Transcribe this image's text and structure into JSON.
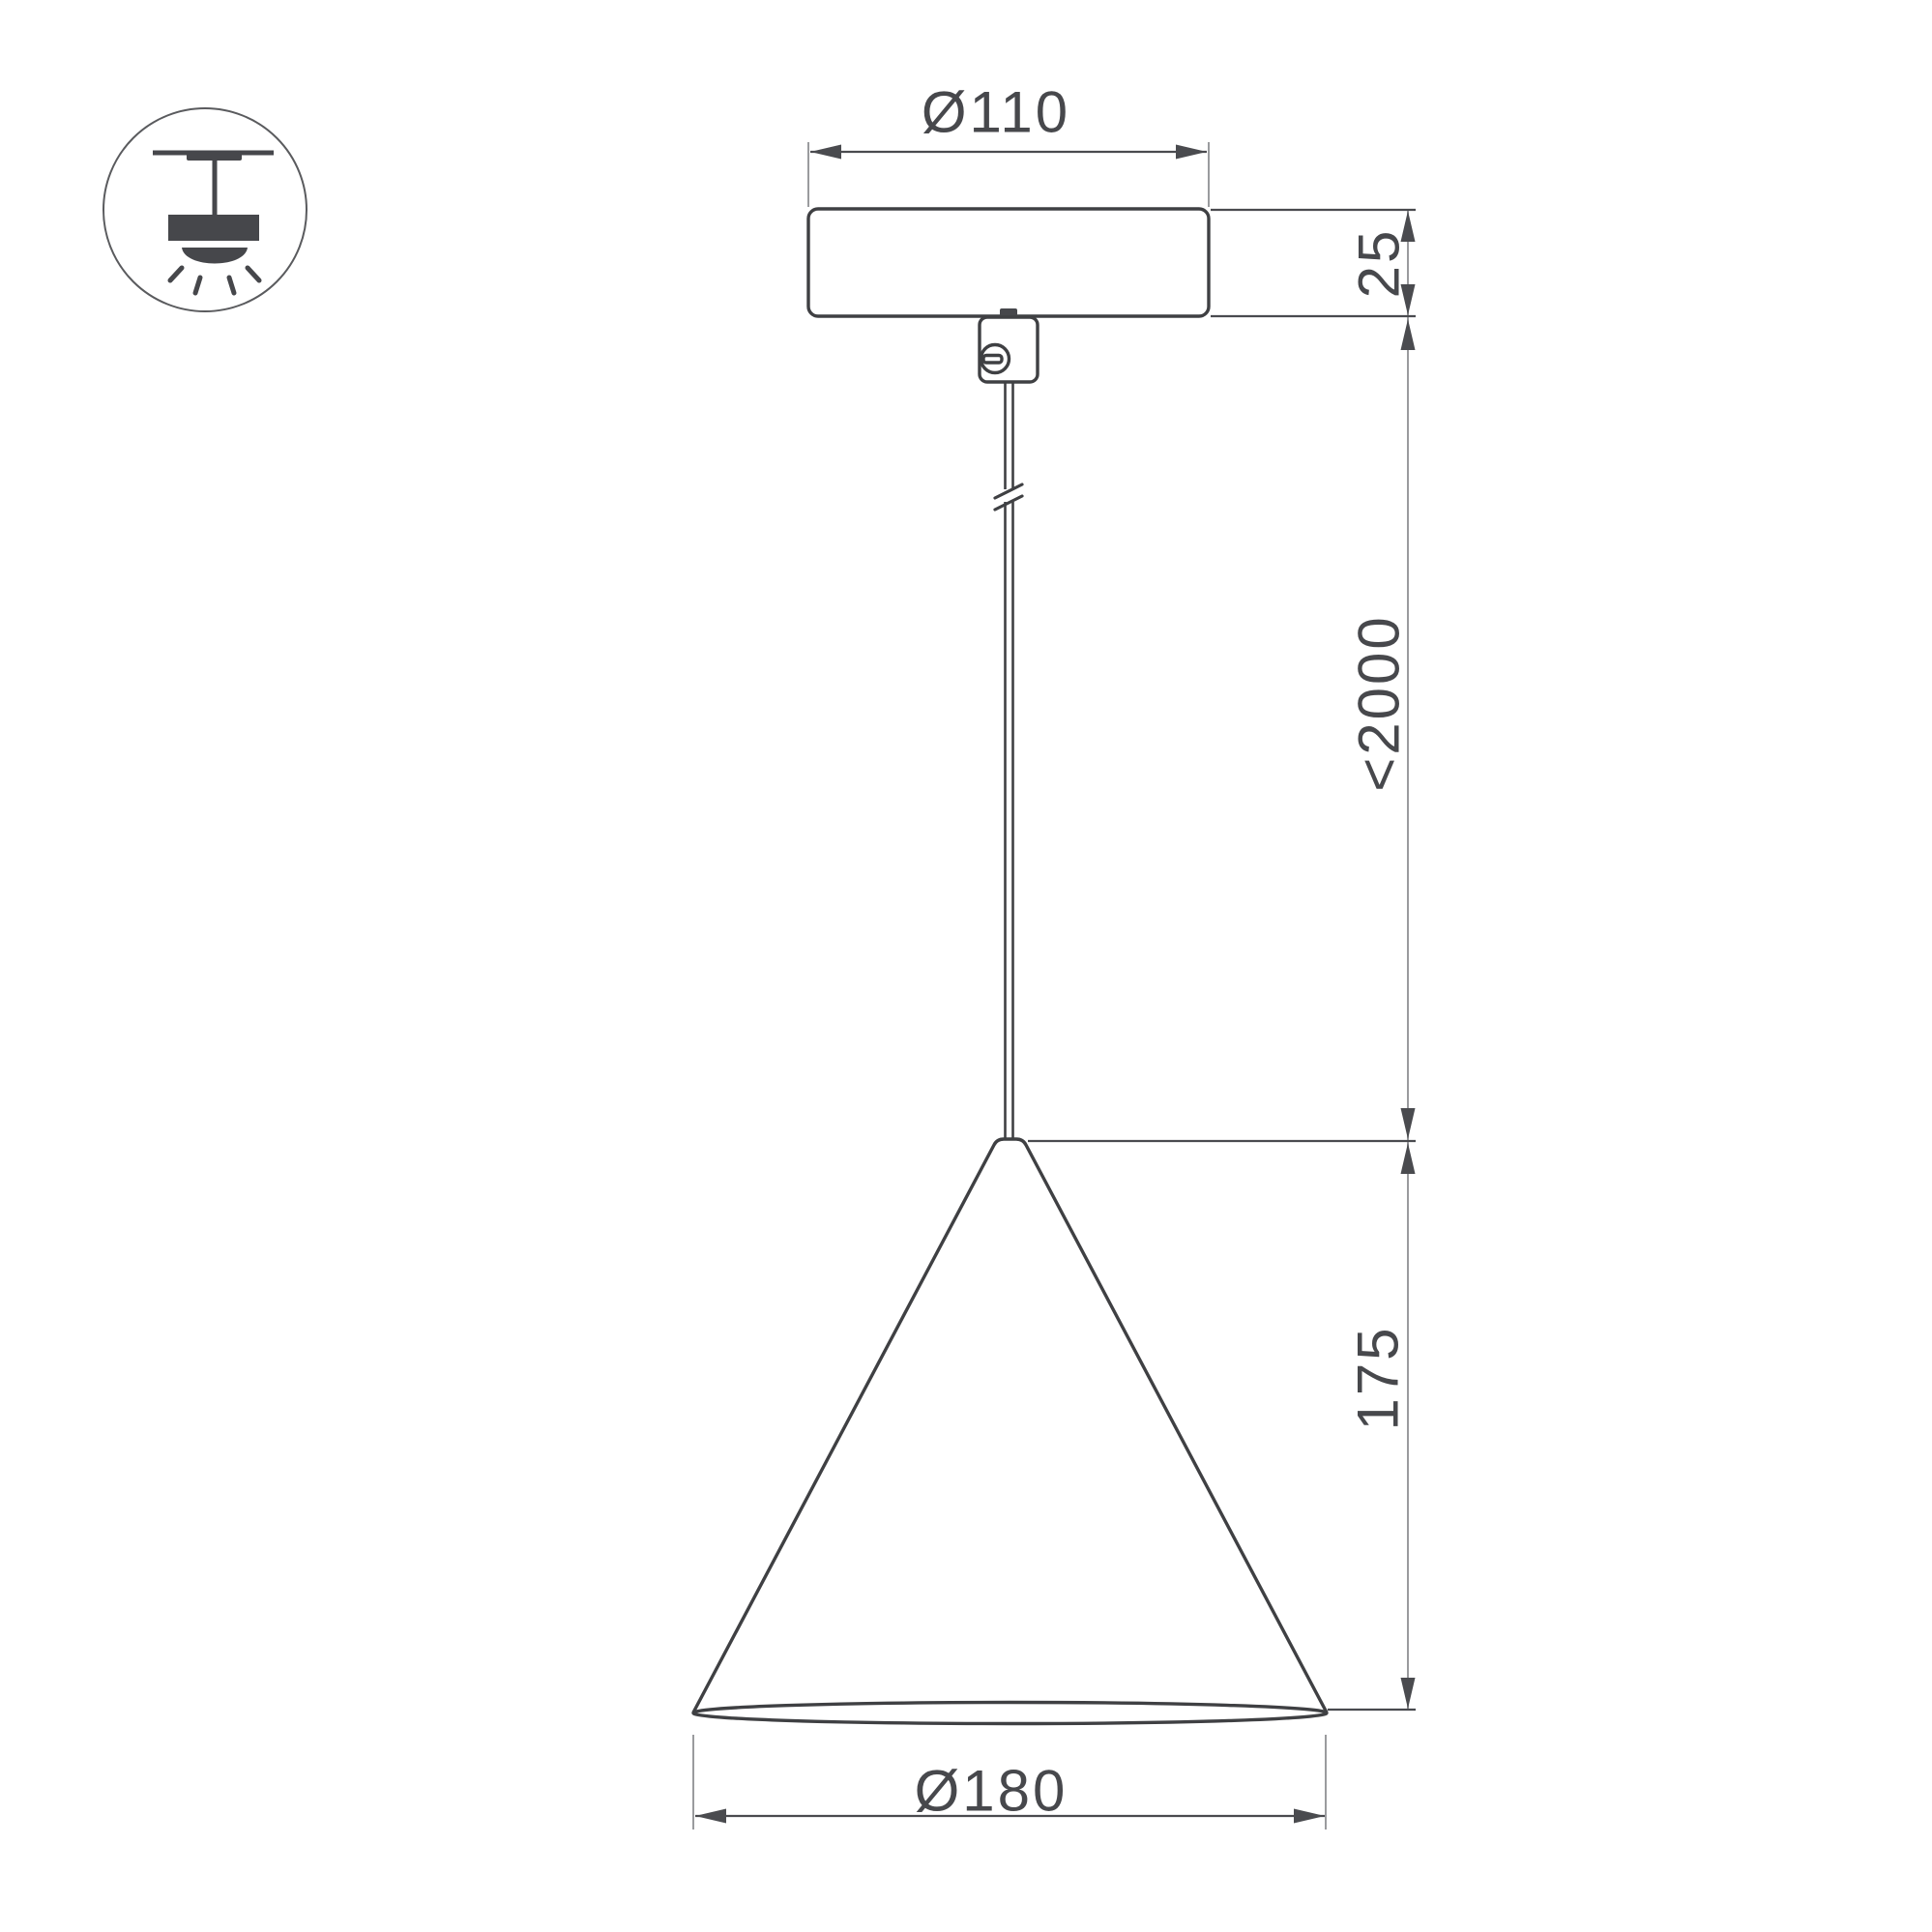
{
  "drawing": {
    "title": "pendant-light-dimension-drawing",
    "dimensions": {
      "canopy_diameter": {
        "label": "Ø110"
      },
      "canopy_height": {
        "label": "25"
      },
      "suspension_max_length": {
        "label": "<2000"
      },
      "shade_height": {
        "label": "175"
      },
      "shade_diameter": {
        "label": "Ø180"
      }
    }
  },
  "legend_icon": {
    "name": "pendant-ceiling-light-icon"
  },
  "colors": {
    "object_line": "#3f4043",
    "dimension_line": "#4a4b4f",
    "extension_line": "#9a9b9e",
    "label_text": "#47484c",
    "icon": "#46474b",
    "background": "#ffffff"
  }
}
